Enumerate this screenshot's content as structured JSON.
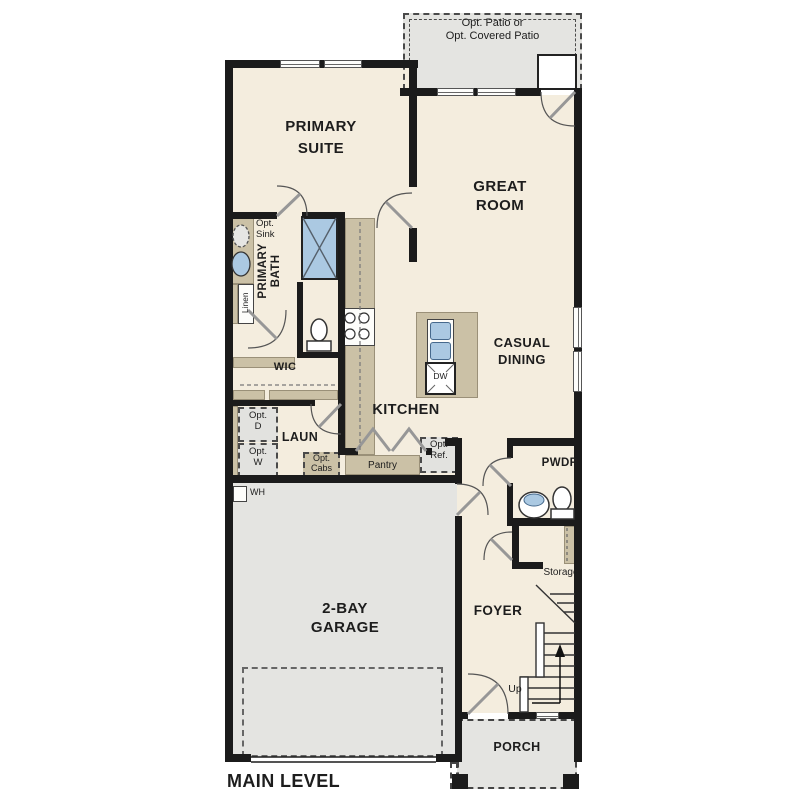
{
  "title": "MAIN LEVEL",
  "colors": {
    "wall": "#1b1b1b",
    "interior": "#f4edde",
    "garage_porch_patio": "#e4e4e1",
    "counter_tan": "#cbc1a6",
    "fixture_blue": "#abc9e2",
    "opt_box_gray": "#e2e2df"
  },
  "rooms": {
    "primary_suite": {
      "line1": "PRIMARY",
      "line2": "SUITE"
    },
    "great_room": {
      "line1": "GREAT",
      "line2": "ROOM"
    },
    "casual_dining": {
      "line1": "CASUAL",
      "line2": "DINING"
    },
    "kitchen": {
      "label": "KITCHEN"
    },
    "primary_bath": {
      "line1": "PRIMARY",
      "line2": "BATH"
    },
    "wic": {
      "label": "WIC"
    },
    "laundry": {
      "label": "LAUN"
    },
    "powder": {
      "label": "PWDR"
    },
    "foyer": {
      "label": "FOYER"
    },
    "garage": {
      "line1": "2-BAY",
      "line2": "GARAGE"
    },
    "porch": {
      "label": "PORCH"
    },
    "storage": {
      "label": "Storage"
    }
  },
  "features": {
    "opt_patio": {
      "line1": "Opt. Patio or",
      "line2": "Opt. Covered Patio"
    },
    "opt_sink": {
      "line1": "Opt.",
      "line2": "Sink"
    },
    "linen": {
      "label": "Linen"
    },
    "opt_dryer": {
      "line1": "Opt.",
      "line2": "D"
    },
    "opt_washer": {
      "line1": "Opt.",
      "line2": "W"
    },
    "opt_cabs": {
      "line1": "Opt.",
      "line2": "Cabs"
    },
    "pantry": {
      "label": "Pantry"
    },
    "opt_ref": {
      "line1": "Opt.",
      "line2": "Ref."
    },
    "dishwasher": {
      "label": "DW"
    },
    "water_heater": {
      "label": "WH"
    },
    "stairs_up": {
      "label": "Up"
    }
  }
}
